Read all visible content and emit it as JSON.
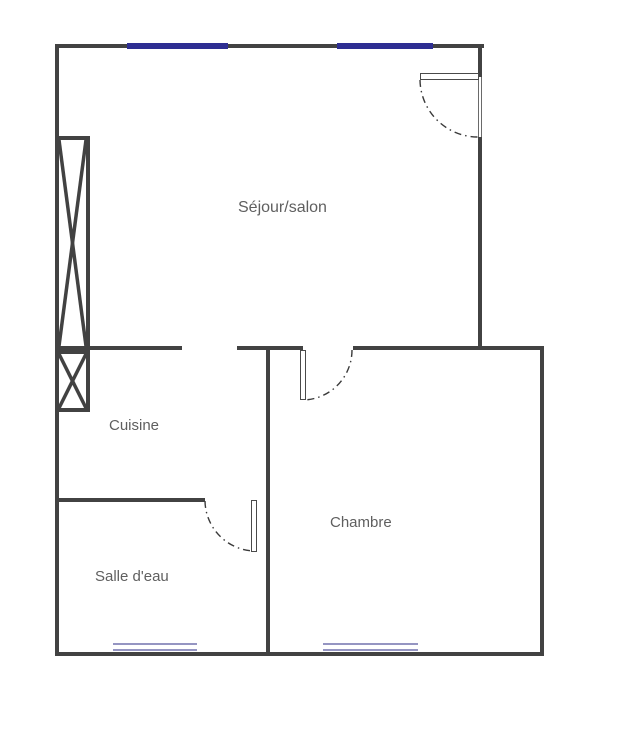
{
  "rooms": {
    "sejour": {
      "label": "Séjour/salon"
    },
    "cuisine": {
      "label": "Cuisine"
    },
    "salle_deau": {
      "label": "Salle d'eau"
    },
    "chambre": {
      "label": "Chambre"
    }
  },
  "features": {
    "windows_top": [
      "window-sejour-left",
      "window-sejour-right"
    ],
    "windows_bottom": [
      "window-salle-deau",
      "window-chambre"
    ],
    "doors": [
      "entrance-door",
      "chambre-door",
      "salle-deau-door"
    ],
    "shafts": [
      "duct-shaft-tall",
      "duct-shaft-small"
    ],
    "openings": [
      "sejour-cuisine-passage"
    ]
  },
  "colors": {
    "wall": "#424242",
    "window_top": "#2e2e92",
    "window_bottom": "#9595c2",
    "label_text": "#5f5f5f",
    "background": "#ffffff"
  }
}
